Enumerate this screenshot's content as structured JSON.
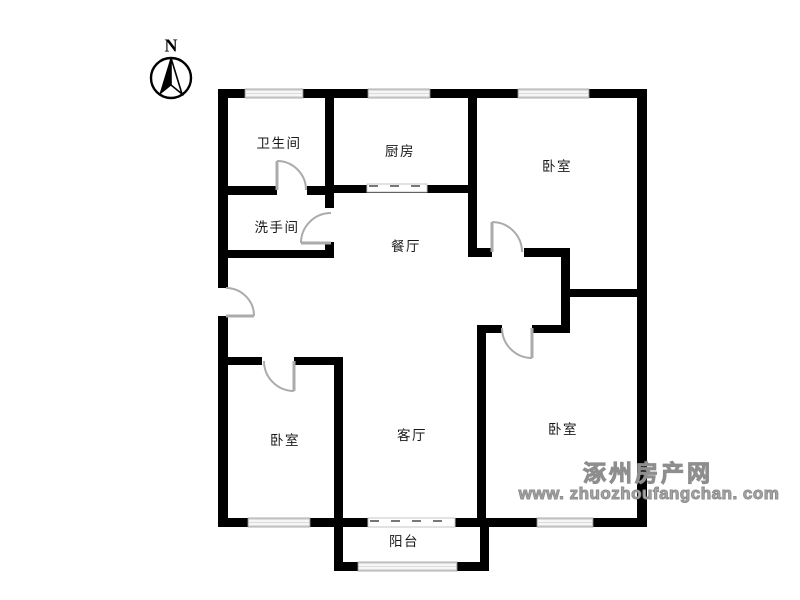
{
  "colors": {
    "wall": "#000000",
    "window_fill": "#dcdcdc",
    "window_line": "#999999",
    "door": "#ababab",
    "label_text": "#1a1a1a",
    "watermark": "#a6a6a6"
  },
  "compass": {
    "north_label": "N"
  },
  "rooms": {
    "bathroom": "卫生间",
    "kitchen": "厨房",
    "bedroom_top_right": "卧室",
    "washroom": "洗手间",
    "dining": "餐厅",
    "living": "客厅",
    "bedroom_bottom_left": "卧室",
    "bedroom_bottom_right": "卧室",
    "balcony": "阳台"
  },
  "watermark": {
    "site_name": "涿州房产网",
    "site_url": "www. zhuozhoufangchan. com"
  }
}
